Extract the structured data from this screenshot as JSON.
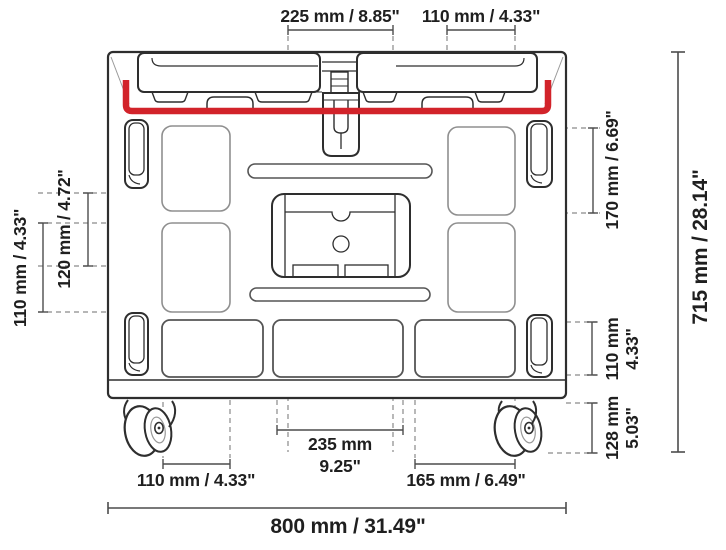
{
  "diagram": {
    "type": "technical-dimension-drawing",
    "subject": "cart with casters - front view",
    "accent_color": "#d2232a",
    "line_color": "#2e2e2e",
    "labels": {
      "top_left_span": "225 mm / 8.85\"",
      "top_right_span": "110 mm / 4.33\"",
      "right_top_height": "170 mm / 6.69\"",
      "right_mid_mm": "110 mm",
      "right_mid_in": "4.33\"",
      "right_wheel_mm": "128 mm",
      "right_wheel_in": "5.03\"",
      "overall_height": "715 mm / 28.14\"",
      "left_inner_height": "120 mm / 4.72\"",
      "left_outer_height": "110 mm / 4.33\"",
      "bottom_center_mm": "235 mm",
      "bottom_center_in": "9.25\"",
      "bottom_left_span": "110 mm / 4.33\"",
      "bottom_right_span": "165 mm / 6.49\"",
      "overall_width": "800 mm / 31.49\""
    }
  }
}
